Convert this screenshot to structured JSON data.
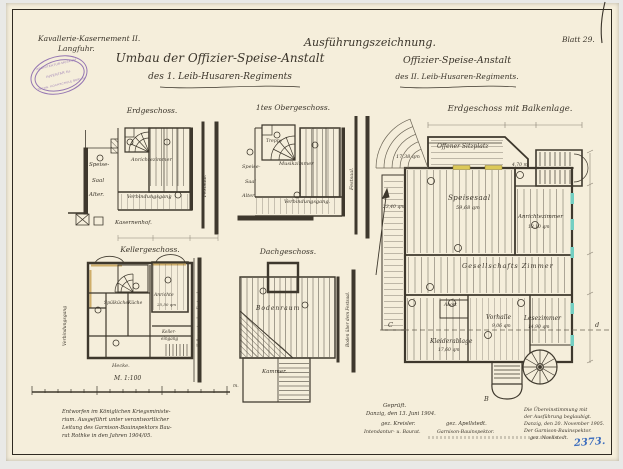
{
  "header": {
    "kasernement_line1": "Kavallerie-Kasernement II.",
    "kasernement_line2": "Langfuhr.",
    "ausfuehrungszeichnung": "Ausführungszeichnung.",
    "blatt": "Blatt 29.",
    "title_umbau_line1": "Umbau der Offizier-Speise-Anstalt",
    "title_umbau_line2": "des 1. Leib-Husaren-Regiments",
    "title_right_line1": "Offizier-Speise-Anstalt",
    "title_right_line2": "des II. Leib-Husaren-Regiments."
  },
  "stamp": {
    "arc_top": "ARCHITEKTUR-MUSEUM",
    "center": "INVENTAR Nr.",
    "arc_bottom": "TECHN. HOCHSCHULE BERLIN"
  },
  "plans": {
    "erdgeschoss": {
      "title": "Erdgeschoss.",
      "speise_1": "Speise-",
      "speise_2": "Saal",
      "speise_3": "Alter.",
      "anrichte": "Anrichtezimmer",
      "gang": "Verbindungsgang",
      "festsaal": "Festsaal.",
      "hof": "Kasernenhof."
    },
    "obergeschoss": {
      "title": "1tes Obergeschoss.",
      "treppe": "Treppe",
      "musik": "Musikzimmer",
      "gang": "Verbindungsgang.",
      "speise_1": "Speise-",
      "speise_2": "Saal",
      "speise_3": "Alter.",
      "festsaal": "Festsaal."
    },
    "keller": {
      "title": "Kellergeschoss.",
      "spuelkueche": "Spülküche",
      "kueche": "Küche",
      "anrichte": "Anrichte",
      "anrichte_qm": "25,50 qm",
      "eingang_1": "Keller-",
      "eingang_2": "eingang",
      "gang": "Verbindungsgang",
      "festsaal": "Keller unter dem Festsaal.",
      "hecke": "Hecke."
    },
    "dach": {
      "title": "Dachgeschoss.",
      "boden": "Bodenraum",
      "kammer": "Kammer.",
      "festsaal": "Boden über dem Festsaal."
    },
    "hauptplan": {
      "title": "Erdgeschoss mit Balkenlage.",
      "sitzplatz": "Offener Sitzplatz",
      "sitzplatz_qm": "17,38 qm",
      "speisesaal": "Speisesaal",
      "speisesaal_qm": "59,68 qm",
      "terrasse_qm": "23,40 qm",
      "anrichte": "Anrichtezimmer",
      "anrichte_qm": "13,10 qm",
      "gesellschaft": "Gesellschafts Zimmer",
      "vorhalle": "Vorhalle",
      "vorhalle_qm": "9,06 qm",
      "lesezimmer": "Lesezimmer",
      "lesezimmer_qm": "14,90 qm",
      "kleiderablage": "Kleiderablage",
      "kleiderablage_qm": "17,60 qm",
      "abort": "Abort",
      "treppe_dim": "4,70 m",
      "section_c": "C",
      "section_d": "d",
      "section_b": "B"
    }
  },
  "scalebar": {
    "label": "M. 1:100",
    "unit": "m."
  },
  "notes": {
    "left_1": "Entworfen im Königlichen Kriegsministe-",
    "left_2": "rium. Ausgeführt unter verantwortlicher",
    "left_3": "Leitung des Garnison-Bauinspektors Bau-",
    "left_4": "rat Rothke in den Jahren 1904/05.",
    "gep_1": "Geprüft.",
    "gep_2": "Danzig, den 13. Juni 1904.",
    "sig_left": "gez. Kreisler.",
    "sig_right": "gez. Apellstedt.",
    "role_left": "Intendantur- u. Baurat.",
    "role_right": "Garnison-Bauinspektor.",
    "right_1": "Die Übereinstimmung mit",
    "right_2": "der Ausführung beglaubigt.",
    "right_3": "Danzig, den 20. November 1905.",
    "right_4": "Der Garnison-Bauinspektor.",
    "right_5": "gez. Noellstedt.",
    "blue_number": "2373."
  }
}
